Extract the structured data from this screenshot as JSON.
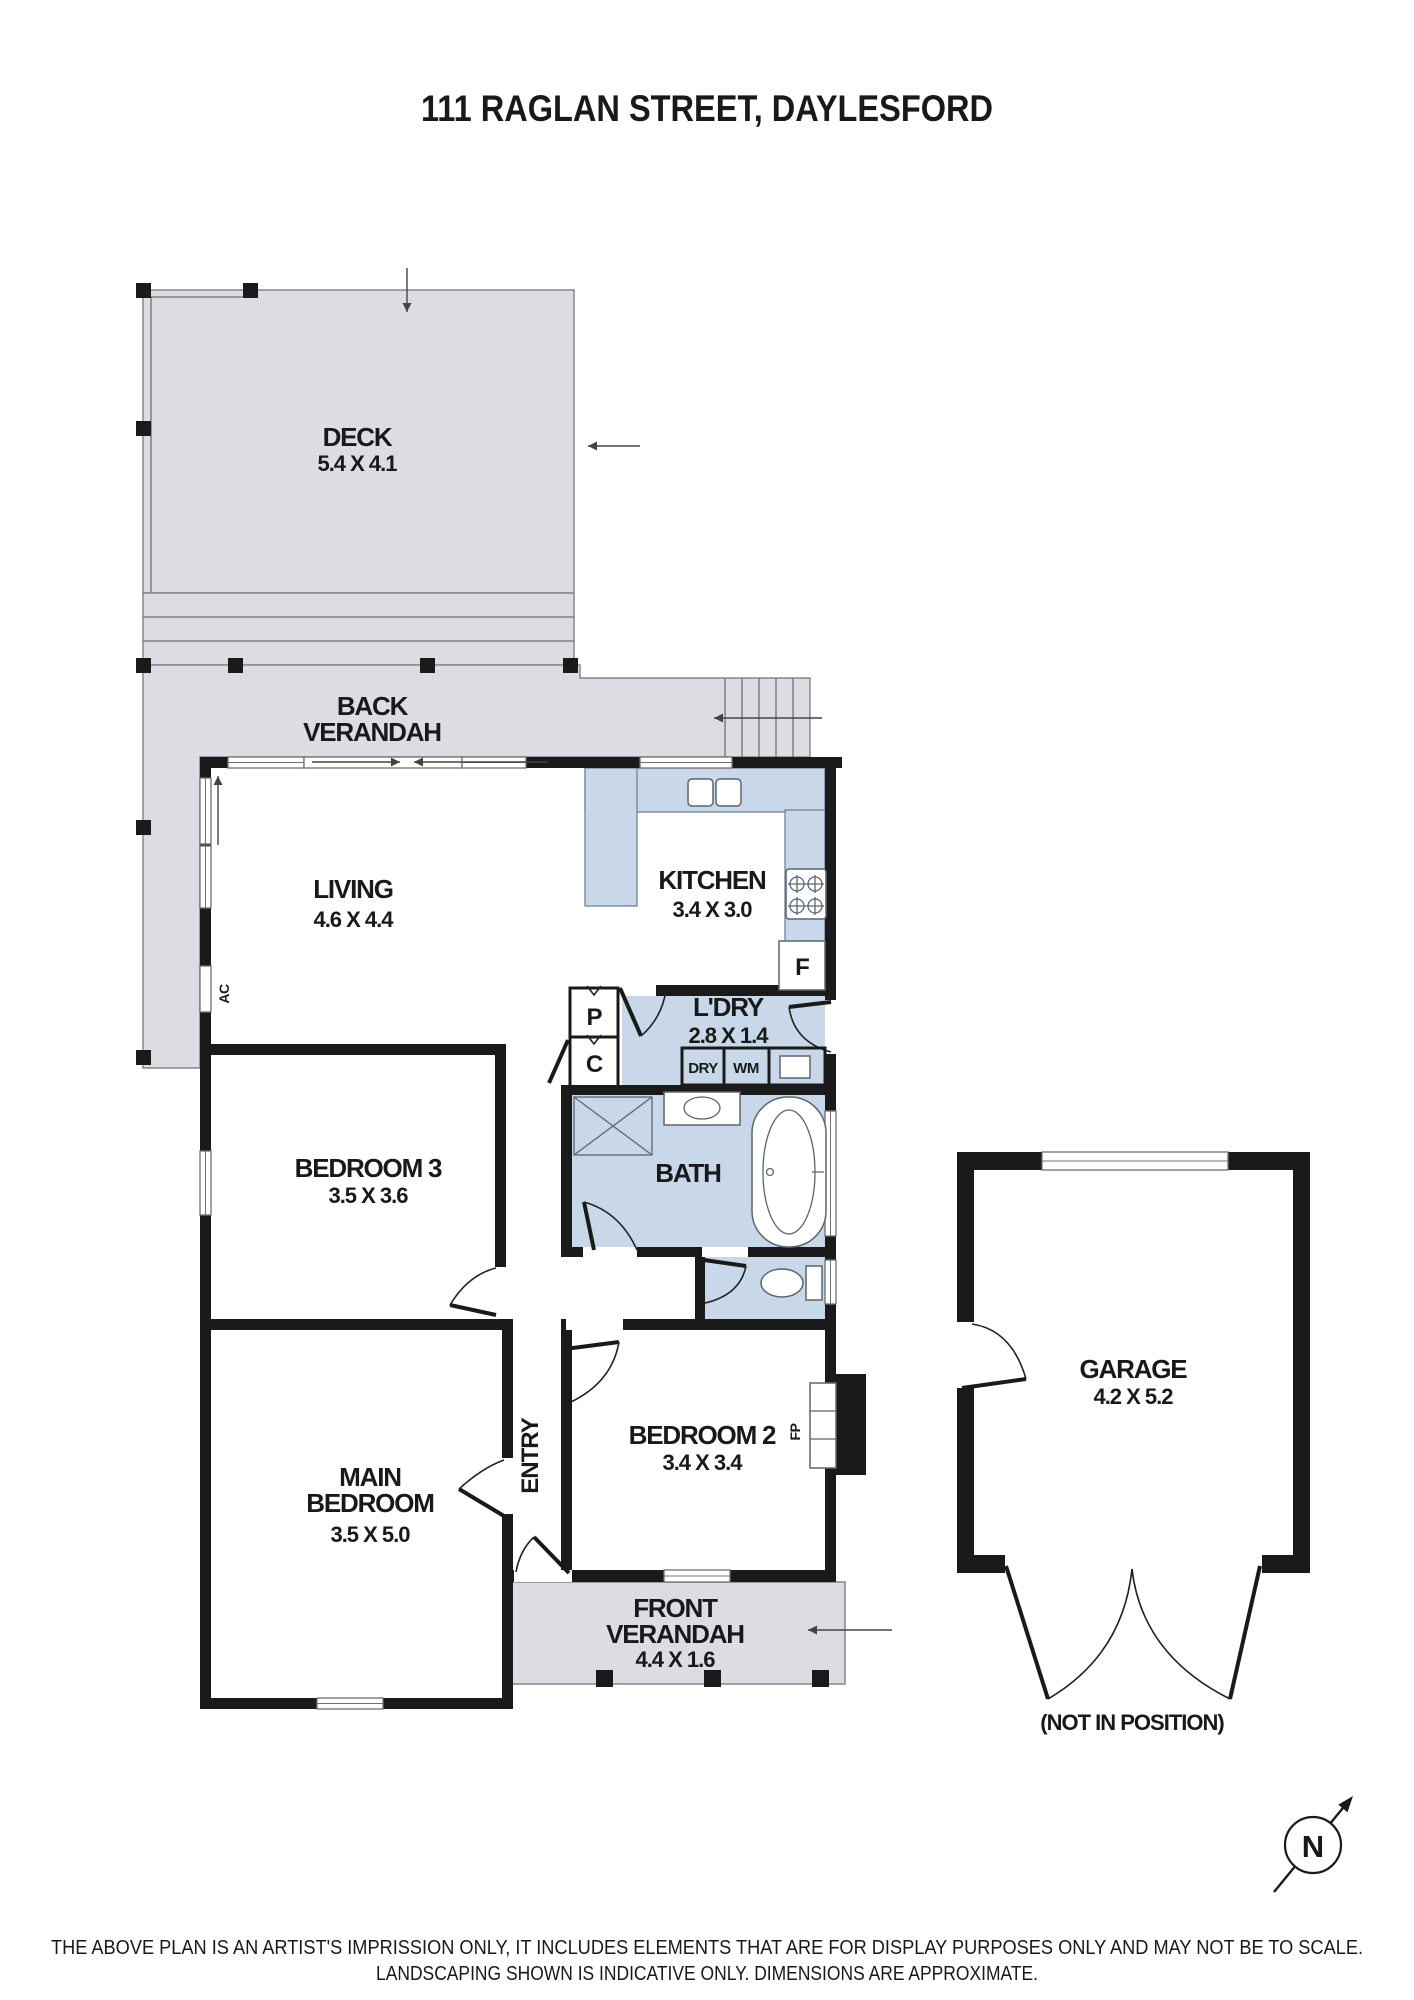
{
  "title": "111 RAGLAN STREET, DAYLESFORD",
  "rooms": {
    "deck": {
      "label": "DECK",
      "dims": "5.4 X 4.1"
    },
    "back_verandah": {
      "label_line1": "BACK",
      "label_line2": "VERANDAH"
    },
    "living": {
      "label": "LIVING",
      "dims": "4.6 X 4.4"
    },
    "kitchen": {
      "label": "KITCHEN",
      "dims": "3.4 X 3.0"
    },
    "laundry": {
      "label": "L'DRY",
      "dims": "2.8 X 1.4"
    },
    "bath": {
      "label": "BATH"
    },
    "bedroom3": {
      "label": "BEDROOM 3",
      "dims": "3.5 X 3.6"
    },
    "main_bedroom": {
      "label_line1": "MAIN",
      "label_line2": "BEDROOM",
      "dims": "3.5 X 5.0"
    },
    "entry": {
      "label": "ENTRY"
    },
    "bedroom2": {
      "label": "BEDROOM 2",
      "dims": "3.4 X 3.4"
    },
    "front_verandah": {
      "label_line1": "FRONT",
      "label_line2": "VERANDAH",
      "dims": "4.4 X 1.6"
    },
    "garage": {
      "label": "GARAGE",
      "dims": "4.2 X 5.2",
      "position_note": "(NOT IN POSITION)"
    }
  },
  "fixtures": {
    "fridge": "F",
    "pantry": "P",
    "cupboard": "C",
    "dryer": "DRY",
    "washing_machine": "WM",
    "air_conditioner": "AC",
    "fireplace": "FP"
  },
  "compass": {
    "north": "N"
  },
  "disclaimer": {
    "line1": "THE ABOVE PLAN IS AN ARTIST'S IMPRISSION ONLY, IT INCLUDES ELEMENTS THAT ARE FOR DISPLAY PURPOSES ONLY AND MAY NOT BE TO SCALE.",
    "line2": "LANDSCAPING SHOWN IS INDICATIVE ONLY. DIMENSIONS ARE APPROXIMATE."
  },
  "colors": {
    "wall": "#1a1a1a",
    "outdoor_fill": "#dcdde2",
    "outdoor_border": "#85878b",
    "wet_area_fill": "#c8d8e9",
    "fixture_stroke": "#5a6673",
    "text": "#191919"
  }
}
